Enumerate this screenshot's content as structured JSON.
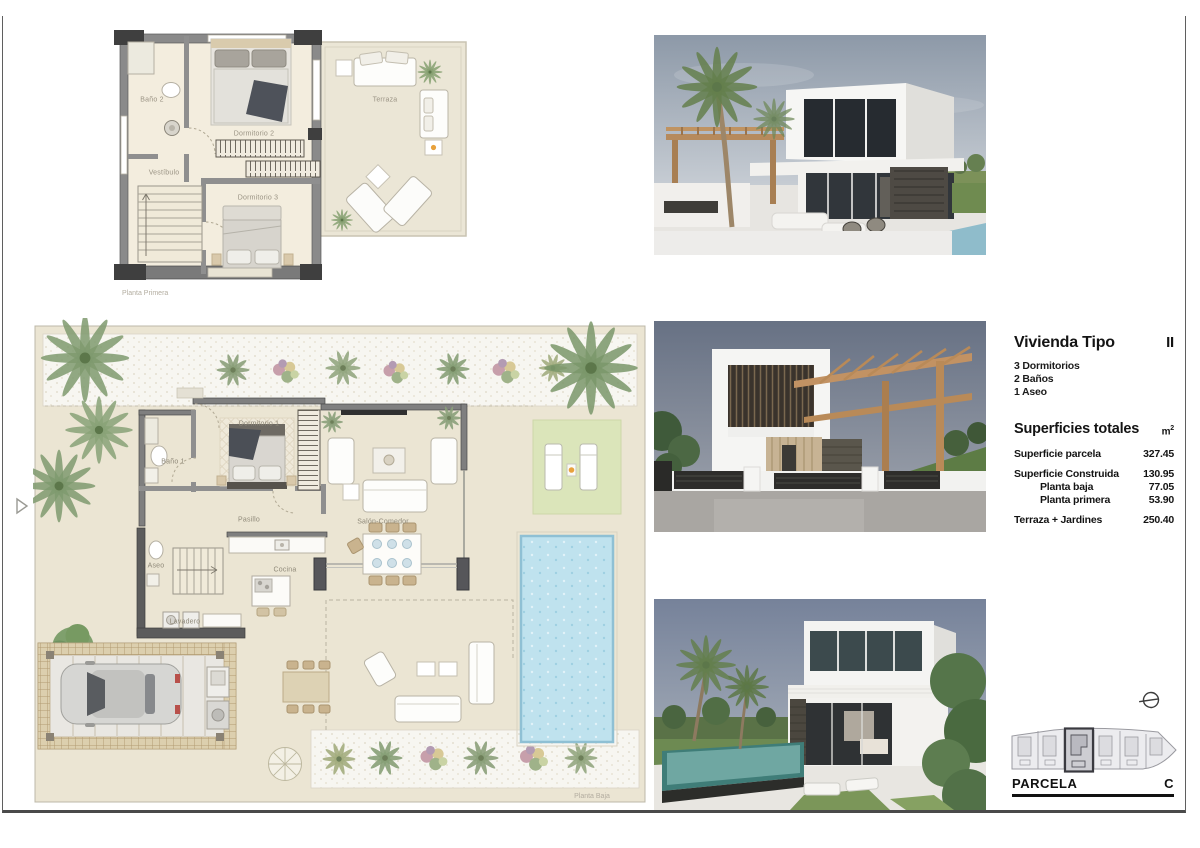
{
  "info_panel": {
    "title": "Vivienda Tipo",
    "type_number": "II",
    "features": [
      "3 Dormitorios",
      "2 Baños",
      "1 Aseo"
    ],
    "areas_title": "Superficies totales",
    "unit_base": "m",
    "unit_exp": "2",
    "rows": [
      {
        "label": "Superficie parcela",
        "value": "327.45"
      },
      {
        "label": "Superficie Construida",
        "value": "130.95"
      },
      {
        "label": "Planta baja",
        "value": "77.05"
      },
      {
        "label": "Planta primera",
        "value": "53.90"
      },
      {
        "label": "Terraza + Jardines",
        "value": "250.40"
      }
    ]
  },
  "parcela": {
    "label": "PARCELA",
    "letter": "C"
  },
  "first_floor": {
    "caption": "Planta Primera",
    "rooms": {
      "bano2": "Baño 2",
      "vestibulo": "Vestíbulo",
      "dorm2": "Dormitorio 2",
      "dorm3": "Dormitorio 3",
      "terraza": "Terraza"
    }
  },
  "ground_floor": {
    "caption": "Planta Baja",
    "rooms": {
      "bano1": "Baño 1",
      "dorm1": "Dormitorio 1",
      "pasillo": "Pasillo",
      "salon": "Salón-Comedor",
      "aseo": "Aseo",
      "cocina": "Cocina",
      "lavadero": "Lavadero"
    }
  },
  "colors": {
    "plan_wall": "#8a8a8a",
    "plan_floor": "#f3edde",
    "pool": "#bfe2ee",
    "lawn": "#dbe5ba",
    "wood": "#c29263",
    "accent_orange": "#e8a13c"
  }
}
